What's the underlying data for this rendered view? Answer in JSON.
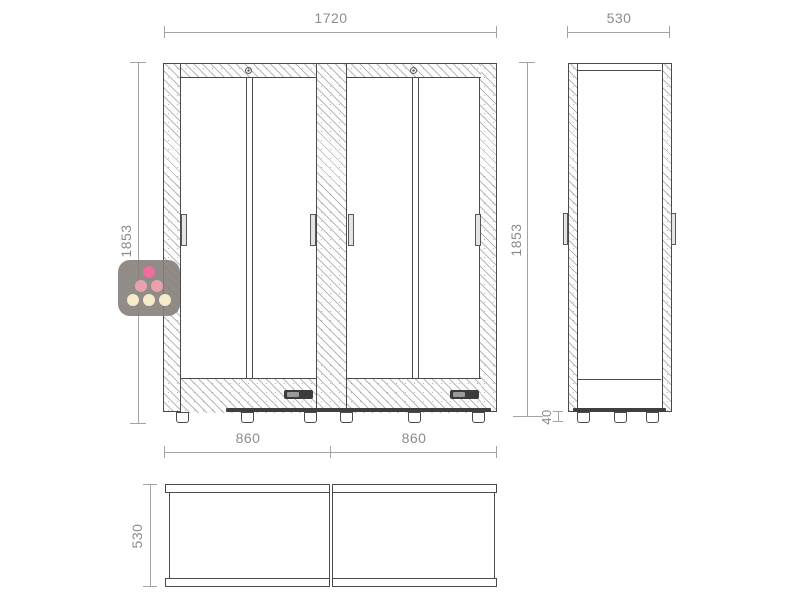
{
  "drawing": {
    "type": "technical-dimension-drawing",
    "subject": "double wine cabinet - front, side and top views",
    "colors": {
      "outline": "#4a4a4a",
      "hatch": "#c9c9c9",
      "dimension_line": "#a3a3a3",
      "dimension_text": "#8c8c8c",
      "control_panel": "#3c3c3c"
    }
  },
  "dimensions": {
    "front_total_width": "1720",
    "front_height": "1853",
    "side_height": "1853",
    "side_width_top": "530",
    "feet_height": "40",
    "unit_width_left": "860",
    "unit_width_right": "860",
    "plan_depth": "530"
  },
  "logo": {
    "name": "wine-cabinet-brand-logo",
    "background": "rgba(133,128,122,0.9)",
    "dot_top": "#ec6f9d",
    "dot_mid": "#eba1ad",
    "dot_bottom": "#f6ecca"
  }
}
